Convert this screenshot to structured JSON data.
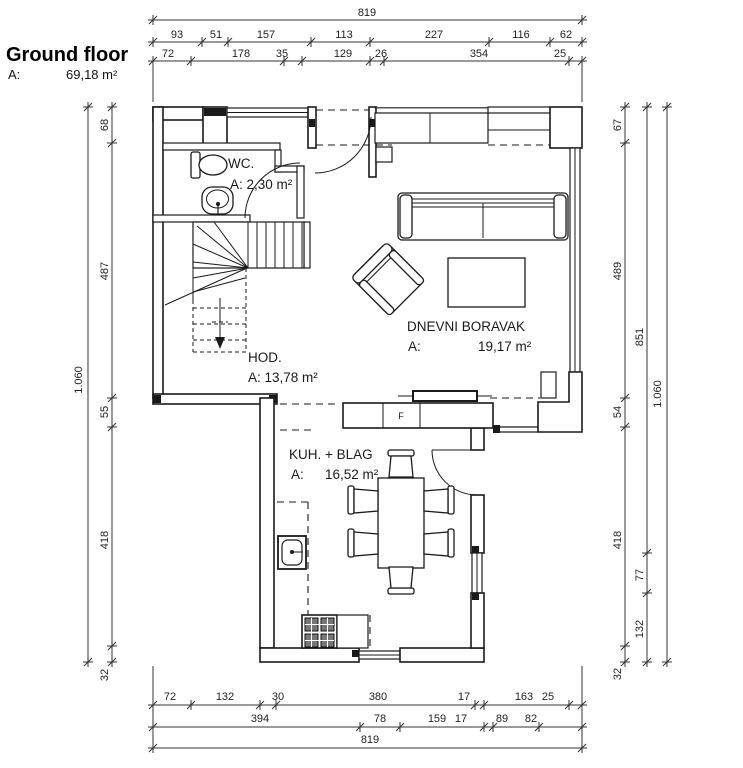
{
  "title": {
    "text": "Ground floor",
    "area_label": "A:",
    "area_value": "69,18 m²"
  },
  "rooms": {
    "wc": {
      "name": "WC.",
      "area": "A: 2,30 m²"
    },
    "hod": {
      "name": "HOD.",
      "area": "A: 13,78 m²"
    },
    "living": {
      "name": "DNEVNI BORAVAK",
      "area_label": "A:",
      "area_value": "19,17 m²"
    },
    "kitchen": {
      "name": "KUH. + BLAG",
      "area_label": "A:",
      "area_value": "16,52 m²"
    }
  },
  "appliances": {
    "fridge_label": "F"
  },
  "dims": {
    "top_total": "819",
    "top_row2": [
      "93",
      "51",
      "157",
      "113",
      "227",
      "116",
      "62"
    ],
    "top_row3": [
      "72",
      "178",
      "35",
      "129",
      "26",
      "354",
      "25"
    ],
    "left_total": "1.060",
    "left_inner": [
      "68",
      "487",
      "55",
      "418",
      "32"
    ],
    "right_inner": [
      "67",
      "489",
      "54",
      "418",
      "32"
    ],
    "right_middle": [
      "851",
      "77",
      "132"
    ],
    "right_total": "1.060",
    "bottom_row1": [
      "72",
      "132",
      "30",
      "380",
      "17",
      "163",
      "25"
    ],
    "bottom_row2": [
      "394",
      "78",
      "159",
      "17",
      "89",
      "82"
    ],
    "bottom_total": "819"
  },
  "colors": {
    "line": "#1a1a1a",
    "background": "#ffffff"
  }
}
